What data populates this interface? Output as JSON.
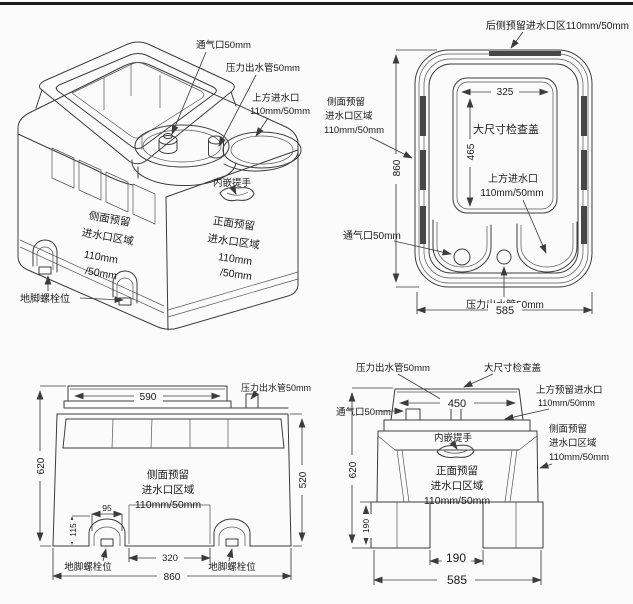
{
  "views": {
    "perspective": {
      "vent": "通气口50mm",
      "pressure_pipe": "压力出水管50mm",
      "top_inlet": [
        "上方进水口",
        "110mm/50mm"
      ],
      "handle": "内嵌提手",
      "side_area": [
        "侧面预留",
        "进水口区域",
        "110mm",
        "/50mm"
      ],
      "front_area": [
        "正面预留",
        "进水口区域",
        "110mm",
        "/50mm"
      ],
      "anchor_bolt": "地脚螺栓位"
    },
    "top": {
      "rear_inlet": "后侧预留进水口区110mm/50mm",
      "side_area": [
        "侧面预留",
        "进水口区域",
        "110mm/50mm"
      ],
      "cover": "大尺寸检查盖",
      "top_inlet": [
        "上方进水口",
        "110mm/50mm"
      ],
      "vent": "通气口50mm",
      "pressure_pipe": "压力出水管50mm",
      "dims": {
        "cover_w": "325",
        "cover_h": "465",
        "length": "860",
        "width": "585"
      }
    },
    "side": {
      "pressure_pipe": "压力出水管50mm",
      "side_area": [
        "侧面预留",
        "进水口区域",
        "110mm/50mm"
      ],
      "anchor_bolt_left": "地脚螺栓位",
      "anchor_bolt_right": "地脚螺栓位",
      "dims": {
        "lid_w": "590",
        "height": "620",
        "body_h": "520",
        "foot_w": "95",
        "foot_h": "115",
        "feet_span": "320",
        "overall_w": "860"
      }
    },
    "front": {
      "pressure_pipe": "压力出水管50mm",
      "cover": "大尺寸检查盖",
      "top_inlet": [
        "上方预留进水口",
        "110mm/50mm"
      ],
      "vent": "通气口50mm",
      "side_area": [
        "侧面预留",
        "进水口区域",
        "110mm/50mm"
      ],
      "handle": "内嵌提手",
      "front_area": [
        "正面预留",
        "进水口区域",
        "110mm/50mm"
      ],
      "dims": {
        "lid_w": "450",
        "height": "620",
        "foot_h": "190",
        "feet_span": "190",
        "overall_w": "585"
      }
    }
  }
}
